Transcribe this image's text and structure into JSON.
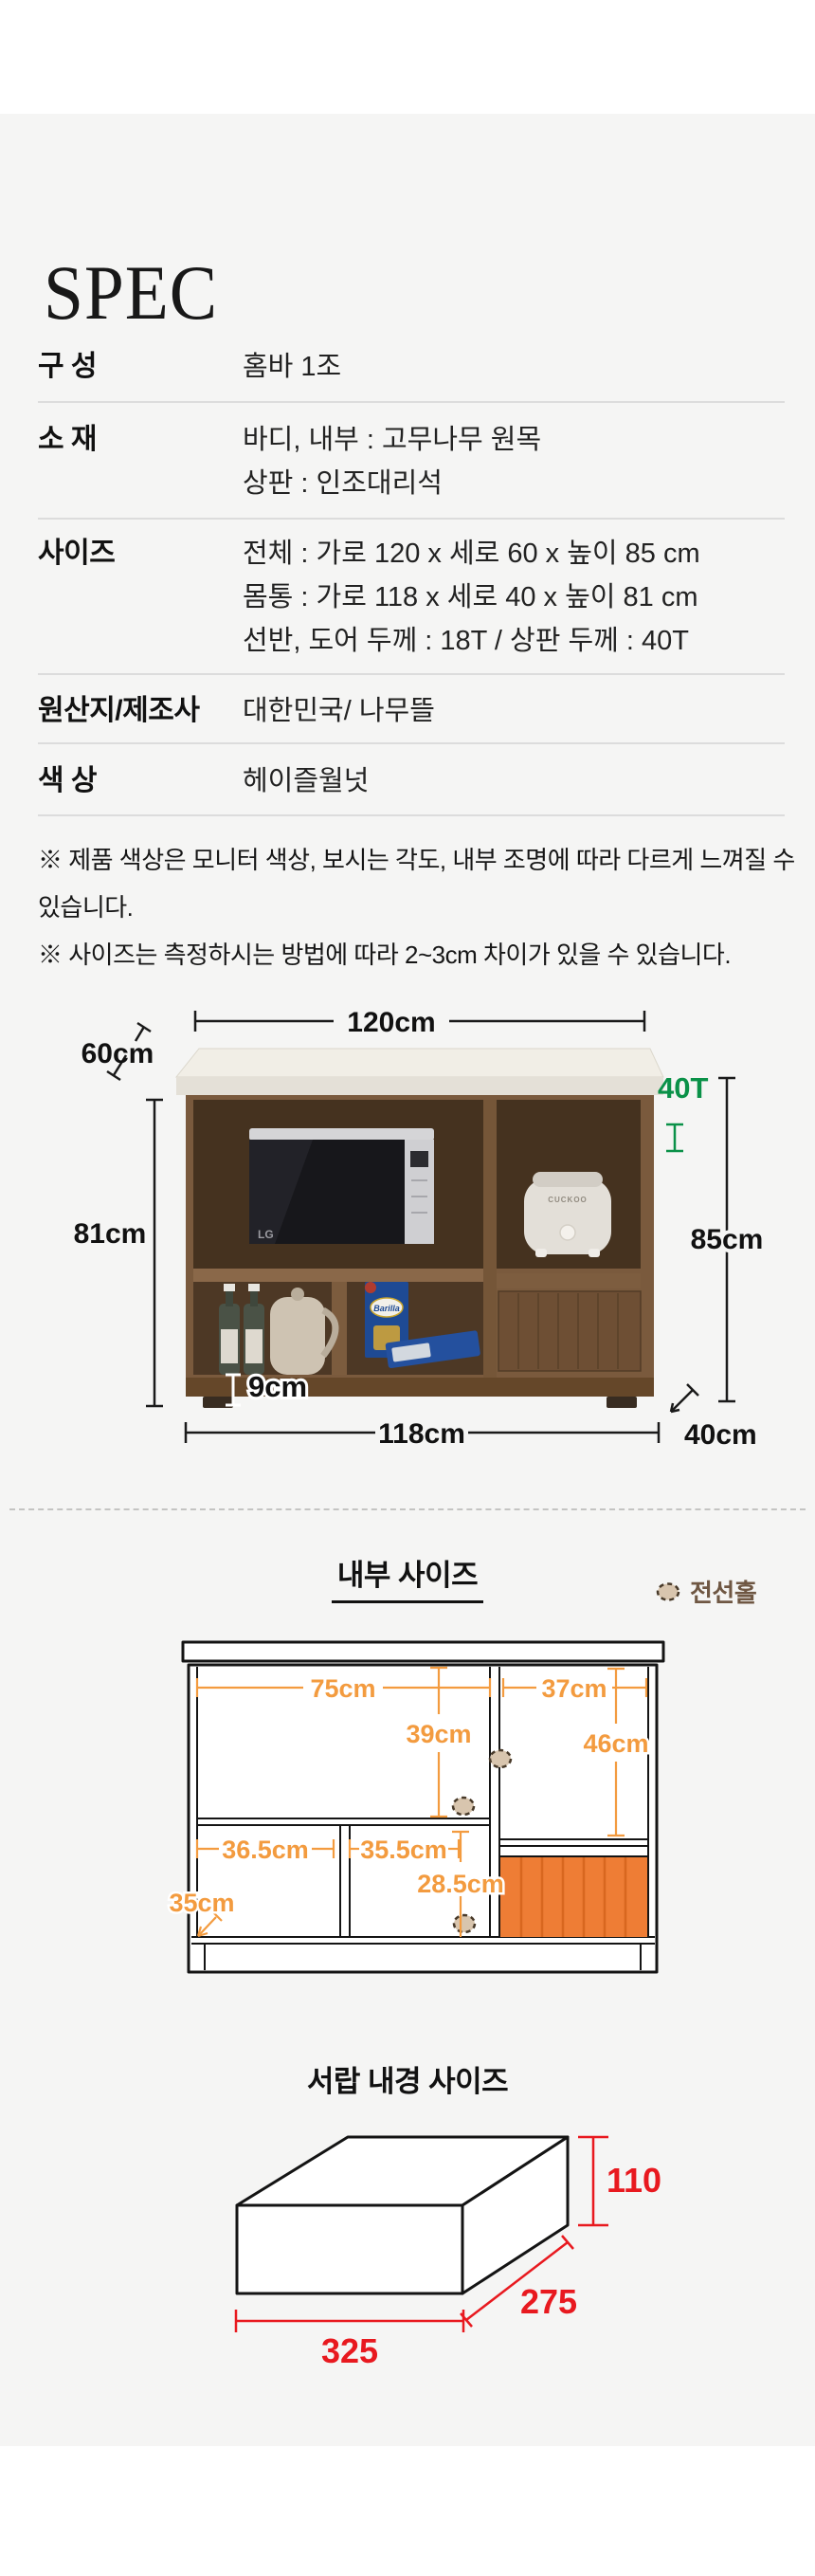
{
  "page": {
    "title": "SPEC"
  },
  "spec_table": {
    "rows": [
      {
        "label": "구 성",
        "values": [
          "홈바 1조"
        ]
      },
      {
        "label": "소 재",
        "values": [
          "바디, 내부 : 고무나무 원목",
          "상판 : 인조대리석"
        ]
      },
      {
        "label": "사이즈",
        "values": [
          "전체 : 가로 120 x 세로 60 x 높이 85 cm",
          "몸통 : 가로 118 x 세로 40 x 높이 81 cm",
          "선반, 도어 두께 : 18T / 상판 두께 : 40T"
        ]
      },
      {
        "label": "원산지/제조사",
        "values": [
          "대한민국/ 나무뜰"
        ]
      },
      {
        "label": "색 상",
        "values": [
          "헤이즐월넛"
        ]
      }
    ]
  },
  "notes": [
    "※ 제품 색상은 모니터 색상, 보시는 각도, 내부 조명에 따라 다르게 느껴질 수 있습니다.",
    "※ 사이즈는 측정하시는 방법에 따라 2~3cm 차이가 있을 수 있습니다."
  ],
  "product_photo": {
    "dim_labels": {
      "top_width": "120cm",
      "top_depth": "60cm",
      "top_thickness": "40T",
      "body_height": "81cm",
      "total_height": "85cm",
      "base_height": "9cm",
      "body_width": "118cm",
      "body_depth": "40cm"
    },
    "appliances": {
      "microwave_brand": "LG",
      "cooker_brand": "CUCKOO",
      "pasta_brand": "Barilla"
    }
  },
  "internal_size": {
    "heading": "내부 사이즈",
    "legend_label": "전선홀",
    "dims": {
      "left_width": "75cm",
      "right_width": "37cm",
      "left_height": "39cm",
      "right_height": "46cm",
      "lower_left_width": "36.5cm",
      "lower_center_width": "35.5cm",
      "drawer_height": "28.5cm",
      "lower_depth": "35cm"
    }
  },
  "drawer_size": {
    "heading": "서랍 내경 사이즈",
    "height": "110",
    "depth": "275",
    "width": "325"
  },
  "colors": {
    "section_bg": "#f5f5f4",
    "accent_orange": "#f39b3f",
    "drawer_fill": "#ee7d35",
    "green": "#0a9148",
    "red": "#e8191f",
    "wirehole_fill": "#d8c5ae",
    "legend_brown": "#6f5743"
  }
}
